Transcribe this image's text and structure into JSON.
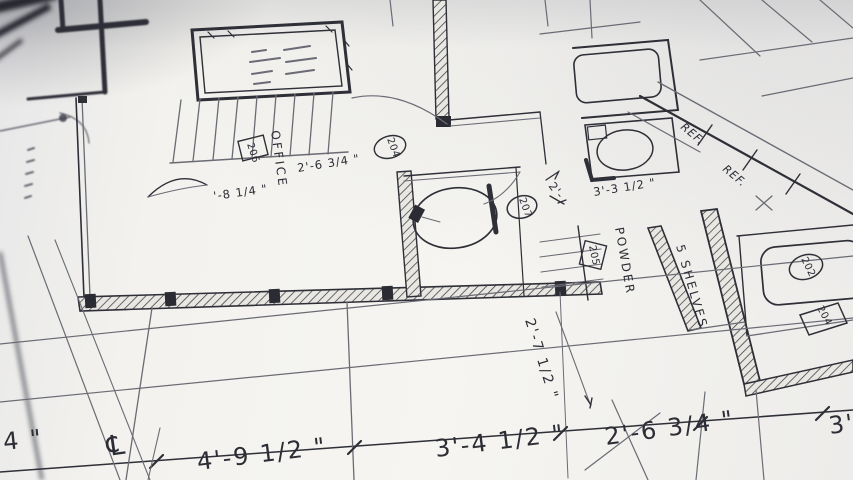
{
  "scene": {
    "description": "Close-up photograph of an architectural floor plan blueprint, viewed at a shallow perspective angle"
  },
  "rooms": {
    "office": "OFFICE",
    "powder": "POWDER",
    "shelves": "5 SHELVES"
  },
  "tags": {
    "office_box": "206",
    "office_door": "204",
    "hall_door": "207",
    "powder_box": "205",
    "closet_circle": "202",
    "closet_box": "204"
  },
  "appliances": {
    "ref_upper": "REF.",
    "ref_lower": "REF."
  },
  "dims": {
    "office_width": "2'-6 3/4 \"",
    "office_left": "'-8 1/4 \"",
    "bath_width": "3'-3 1/2 \"",
    "hall_partial": "2'-",
    "stair_height": "2'-7 1/2 \"",
    "bottom_partial": "4 \"",
    "centerline_symbol": "℄",
    "bottom_a": "4'-9 1/2 \"",
    "bottom_b": "3'-4 1/2 \"",
    "bottom_c": "2'-6 3/4 \"",
    "bottom_right_partial": "3'"
  },
  "colors": {
    "paper": "#f4f3ef",
    "ink": "#2e2f37",
    "ink_light": "#6a6b74",
    "hatch": "#3a3b44"
  }
}
